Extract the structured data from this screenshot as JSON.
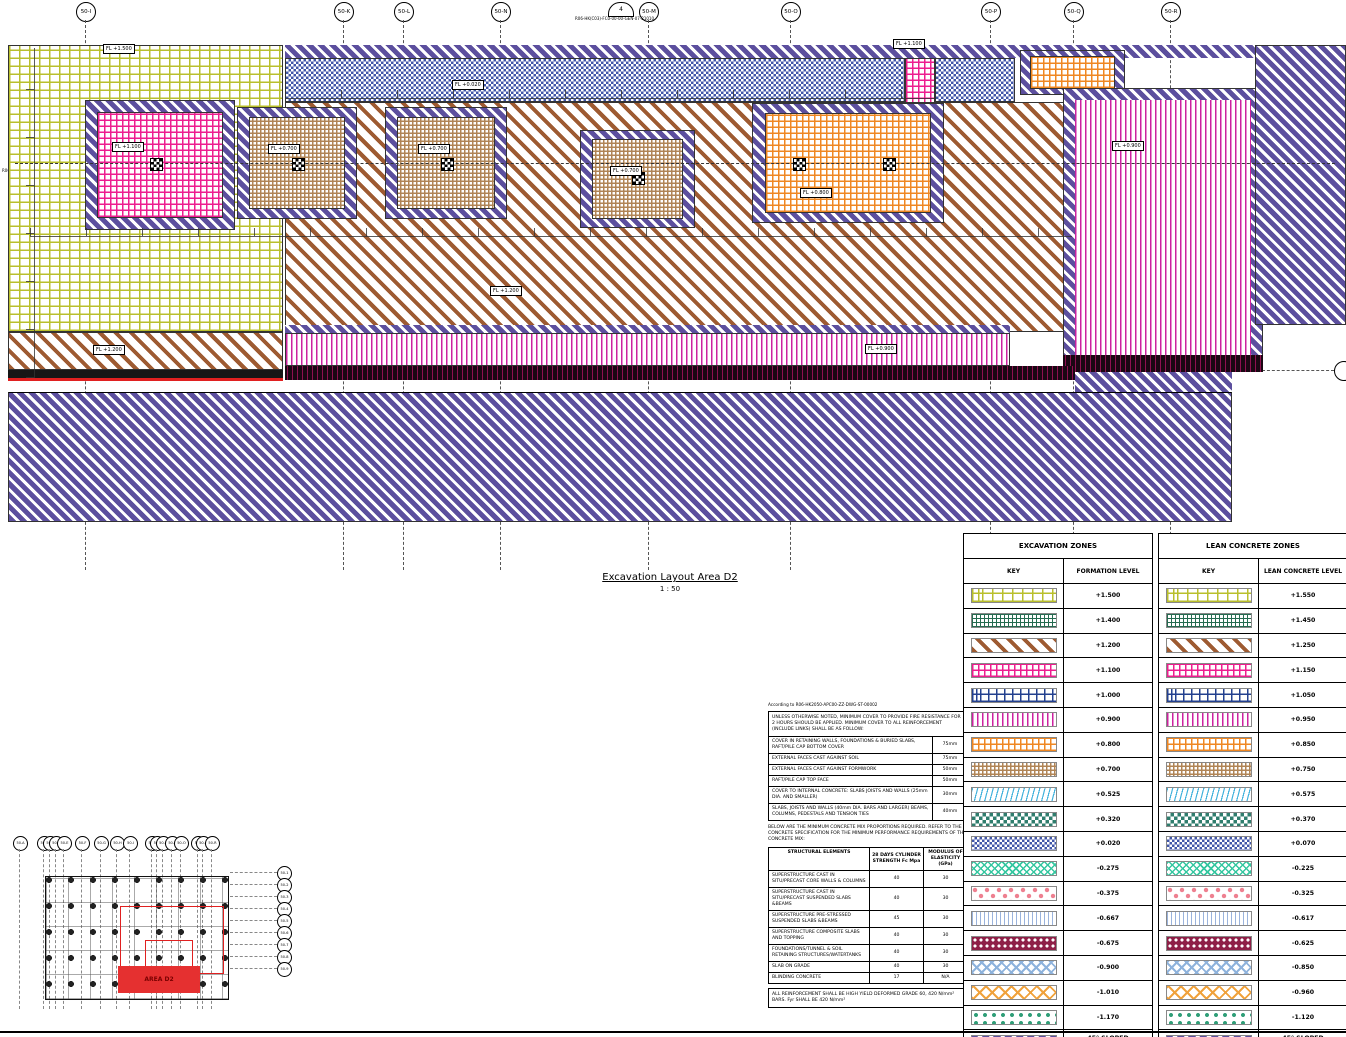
{
  "title": {
    "text": "Excavation Layout Area D2",
    "scale": "1 : 50"
  },
  "grid": {
    "top": [
      "50-I",
      "50-K",
      "50-L",
      "50-N",
      "50-M",
      "50-O",
      "50-P",
      "50-Q",
      "50-R"
    ],
    "section_marker": {
      "number": "4",
      "ref": "R06-HK(C03)-FC0-00-00-GEN-07-21010"
    },
    "left_ref": "R06-HK(C03)-FC0-00-00-GEN-07-21010"
  },
  "plan": {
    "labels": {
      "fl_1500": "FL +1.500",
      "fl_0020": "FL +0.020",
      "fl_1100": "FL +1.100",
      "fl_1200": "FL +1.200",
      "fl_0700": "FL +0.700",
      "fl_0800": "FL +0.800",
      "fl_0900": "FL +0.900"
    }
  },
  "key_plan": {
    "area_label": "AREA D2",
    "top_bubbles": [
      "50-A",
      "50-B",
      "50-C",
      "50-D",
      "50-E",
      "50-F",
      "50-G",
      "50-H",
      "50-I",
      "50-K",
      "50-L",
      "50-M",
      "50-N",
      "50-O",
      "50-P",
      "50-Q",
      "50-R"
    ],
    "side_bubbles": [
      "50-1",
      "50-2",
      "50-3",
      "50-4",
      "50-5",
      "50-6",
      "50-7",
      "50-8",
      "50-9"
    ]
  },
  "notes": {
    "according": "According to R06-HK2050-APC00-ZZ-DWG-ST-00002",
    "cover_intro": "UNLESS OTHERWISE NOTED, MINIMUM COVER TO PROVIDE FIRE RESISTANCE FOR 2 HOURS SHOULD BE APPLIED. MINIMUM COVER TO ALL REINFORCEMENT (INCLUDE LINKS) SHALL BE AS FOLLOW:",
    "cover_rows": [
      {
        "desc": "COVER IN RETAINING WALLS, FOUNDATIONS & BURIED SLABS, RAFT/PILE CAP BOTTOM COVER",
        "value": "75mm"
      },
      {
        "desc": "EXTERNAL FACES CAST AGAINST SOIL",
        "value": "75mm"
      },
      {
        "desc": "EXTERNAL FACES CAST AGAINST FORMWORK",
        "value": "50mm"
      },
      {
        "desc": "RAFT/PILE CAP TOP FACE",
        "value": "50mm"
      },
      {
        "desc": "COVER TO INTERNAL CONCRETE: SLABS JOISTS AND WALLS (25mm DIA. AND SMALLER)",
        "value": "30mm"
      },
      {
        "desc": "SLABS, JOISTS AND WALLS (40mm DIA. BARS AND LARGER) BEAMS, COLUMNS, PEDESTALS AND TENSION TIES",
        "value": "40mm"
      }
    ],
    "mix_intro": "BELOW ARE THE MINIMUM CONCRETE MIX PROPORTIONS REQUIRED. REFER TO THE CONCRETE SPECIFICATION FOR THE MINIMUM PERFORMANCE REQUIREMENTS OF THE CONCRETE MIX:",
    "mix_headers": [
      "STRUCTURAL ELEMENTS",
      "28 DAYS CYLINDER STRENGTH Fc Mpa",
      "MODULUS OF ELASTICITY (GPa)"
    ],
    "mix_rows": [
      [
        "SUPERSTRUCTURE CAST IN SITU/PRECAST CORE WALLS & COLUMNS",
        "40",
        "30"
      ],
      [
        "SUPERSTRUCTURE CAST IN SITU/PRECAST SUSPENDED SLABS &BEAMS",
        "40",
        "30"
      ],
      [
        "SUPERSTRUCTURE PRE-STRESSED SUSPENDED SLABS &BEAMS",
        "45",
        "30"
      ],
      [
        "SUPERSTRUCTURE COMPOSITE SLABS AND TOPPING",
        "40",
        "30"
      ],
      [
        "FOUNDATIONS/TUNNEL & SOIL RETAINING STRUCTURES/WATERTANKS",
        "40",
        "30"
      ],
      [
        "SLAB ON GRADE",
        "40",
        "30"
      ],
      [
        "BLINDING CONCRETE",
        "17",
        "N/A"
      ]
    ],
    "reinforcement_note": "ALL REINFORCEMENT SHALL BE HIGH YIELD DEFORMED GRADE 60, 420 N/mm² BARS. Fyr SHALL BE 420 N/mm²"
  },
  "legend_excavation": {
    "title": "EXCAVATION ZONES",
    "key_header": "KEY",
    "level_header": "FORMATION LEVEL",
    "rows": [
      {
        "pattern": "brick-yellow",
        "level": "+1.500"
      },
      {
        "pattern": "grid-green",
        "level": "+1.400"
      },
      {
        "pattern": "diag-brown",
        "level": "+1.200"
      },
      {
        "pattern": "squares-pink",
        "level": "+1.100"
      },
      {
        "pattern": "brick-navy",
        "level": "+1.000"
      },
      {
        "pattern": "vlines-magenta",
        "level": "+0.900"
      },
      {
        "pattern": "grid-orange",
        "level": "+0.800"
      },
      {
        "pattern": "weave-brown",
        "level": "+0.700"
      },
      {
        "pattern": "waves-cyan",
        "level": "+0.525"
      },
      {
        "pattern": "checker-teal",
        "level": "+0.320"
      },
      {
        "pattern": "octagon-blue",
        "level": "+0.020"
      },
      {
        "pattern": "tri-teal",
        "level": "-0.275"
      },
      {
        "pattern": "diamond-red",
        "level": "-0.375"
      },
      {
        "pattern": "wave-lightblue",
        "level": "-0.667"
      },
      {
        "pattern": "honey-maroon",
        "level": "-0.675"
      },
      {
        "pattern": "cross-lightblue",
        "level": "-0.900"
      },
      {
        "pattern": "cross-orange",
        "level": "-1.010"
      },
      {
        "pattern": "nabla-green",
        "level": "-1.170"
      },
      {
        "pattern": "diag-purple",
        "level": "45° SLOPED EXCAVATION"
      }
    ]
  },
  "legend_lean": {
    "title": "LEAN CONCRETE ZONES",
    "key_header": "KEY",
    "level_header": "LEAN CONCRETE LEVEL",
    "rows": [
      {
        "pattern": "brick-yellow",
        "level": "+1.550"
      },
      {
        "pattern": "grid-green",
        "level": "+1.450"
      },
      {
        "pattern": "diag-brown",
        "level": "+1.250"
      },
      {
        "pattern": "squares-pink",
        "level": "+1.150"
      },
      {
        "pattern": "brick-navy",
        "level": "+1.050"
      },
      {
        "pattern": "vlines-magenta",
        "level": "+0.950"
      },
      {
        "pattern": "grid-orange",
        "level": "+0.850"
      },
      {
        "pattern": "weave-brown",
        "level": "+0.750"
      },
      {
        "pattern": "waves-cyan",
        "level": "+0.575"
      },
      {
        "pattern": "checker-teal",
        "level": "+0.370"
      },
      {
        "pattern": "octagon-blue",
        "level": "+0.070"
      },
      {
        "pattern": "tri-teal",
        "level": "-0.225"
      },
      {
        "pattern": "diamond-red",
        "level": "-0.325"
      },
      {
        "pattern": "wave-lightblue",
        "level": "-0.617"
      },
      {
        "pattern": "honey-maroon",
        "level": "-0.625"
      },
      {
        "pattern": "cross-lightblue",
        "level": "-0.850"
      },
      {
        "pattern": "cross-orange",
        "level": "-0.960"
      },
      {
        "pattern": "nabla-green",
        "level": "-1.120"
      },
      {
        "pattern": "diag-purple",
        "level": "45° SLOPED EXCAVATION"
      }
    ]
  }
}
